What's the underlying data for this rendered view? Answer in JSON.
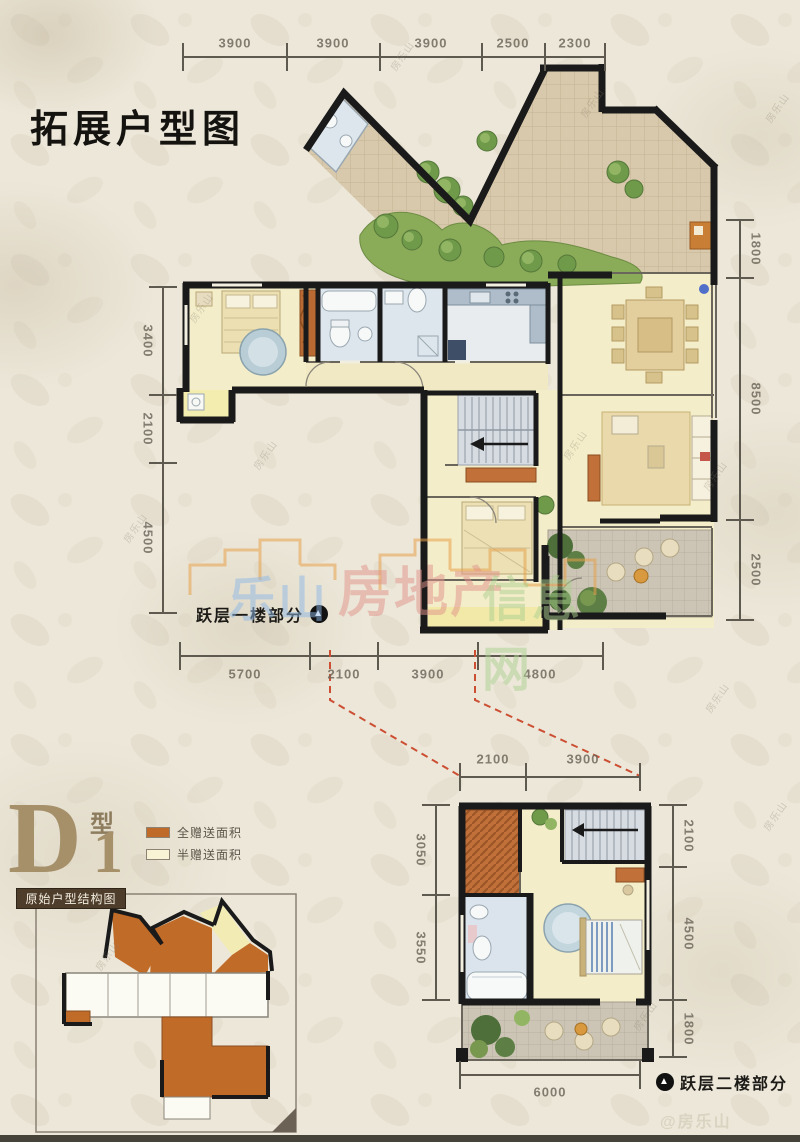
{
  "page": {
    "title": "拓展户型图",
    "bottom_watermark": "@房乐山",
    "scatter_watermark": "房乐山",
    "center_watermark": {
      "part1": "乐山",
      "part2": "房地产",
      "part3": "信息网"
    }
  },
  "floor1": {
    "label": "跃层一楼部分",
    "dims_top": [
      "3900",
      "3900",
      "3900",
      "2500",
      "2300"
    ],
    "dims_left": [
      "3400",
      "2100",
      "4500"
    ],
    "dims_right": [
      "1800",
      "8500",
      "2500"
    ],
    "dims_bottom": [
      "5700",
      "2100",
      "3900",
      "4800"
    ]
  },
  "floor2": {
    "label": "跃层二楼部分",
    "dims_top": [
      "2100",
      "3900"
    ],
    "dims_left": [
      "3050",
      "3550"
    ],
    "dims_right": [
      "2100",
      "4500",
      "1800"
    ],
    "dims_bottom": [
      "6000"
    ]
  },
  "type_block": {
    "letter": "D",
    "suffix": "型",
    "number": "1",
    "legend": [
      {
        "label": "全赠送面积",
        "color": "#bf6a28"
      },
      {
        "label": "半赠送面积",
        "color": "#f8f3d4"
      }
    ],
    "mini_plan_title": "原始户型结构图"
  },
  "colors": {
    "wall": "#1a1a1a",
    "dim_line": "#5f5a50",
    "red_dash": "#cc4f33",
    "floor_cream": "#f4edca",
    "terrace_tan": "#d8c9ac",
    "garden_green": "#6f9a4a",
    "accent_orange": "#bf6a28"
  }
}
